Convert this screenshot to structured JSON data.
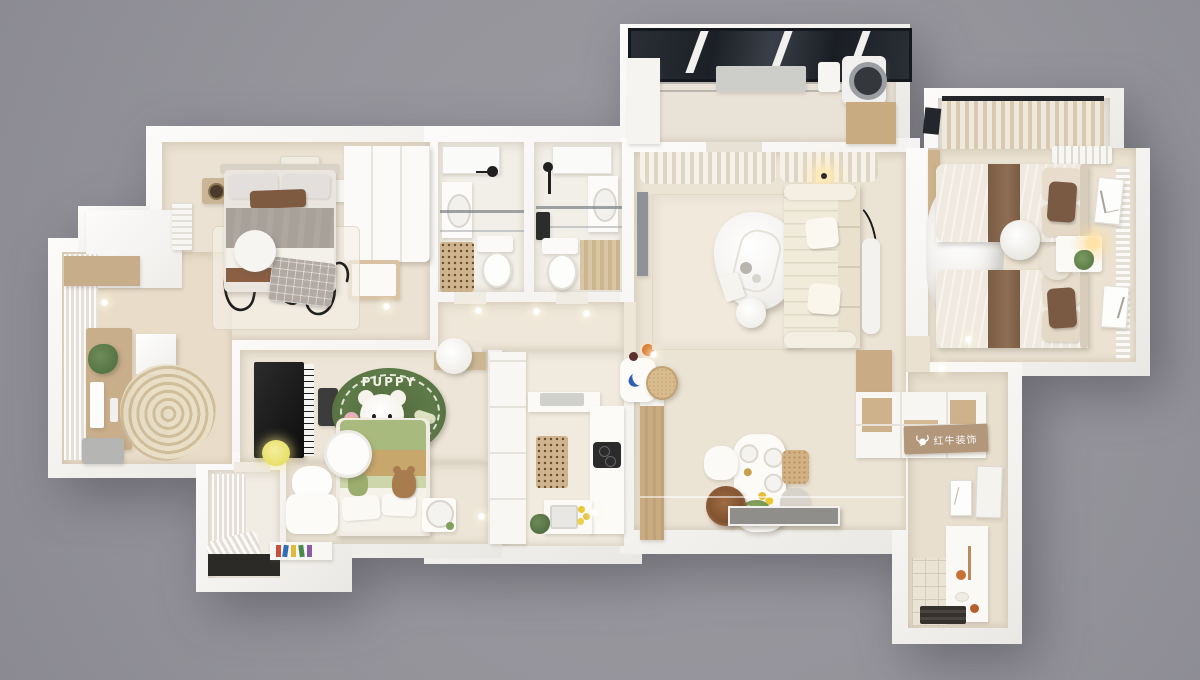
{
  "canvas": {
    "width": 1200,
    "height": 680,
    "background_color": "#97969c"
  },
  "scene": "3d-top-down-apartment-floorplan-render",
  "texts": {
    "kids_rug_label": "PUPPY",
    "watermark_label": "红牛装饰"
  },
  "icons": {
    "watermark_logo": "bull-icon"
  },
  "palette": {
    "outer_background": "#97969c",
    "walls": "#f8f7f5",
    "floor_warm": "#ebe2d3",
    "floor_cool": "#f1ece2",
    "wood": "#c9ab82",
    "wood_dark": "#8a5a36",
    "textile_brown": "#8a6a50",
    "rug_green": "#5e7a48",
    "bed_green": "#a9ba7e",
    "bed_tan": "#c8a76c",
    "sofa_cream": "#f1ebdb",
    "glazing": "#23262b",
    "lamp_yellow": "#e8e066",
    "watermark_panel": "#b2977a"
  }
}
